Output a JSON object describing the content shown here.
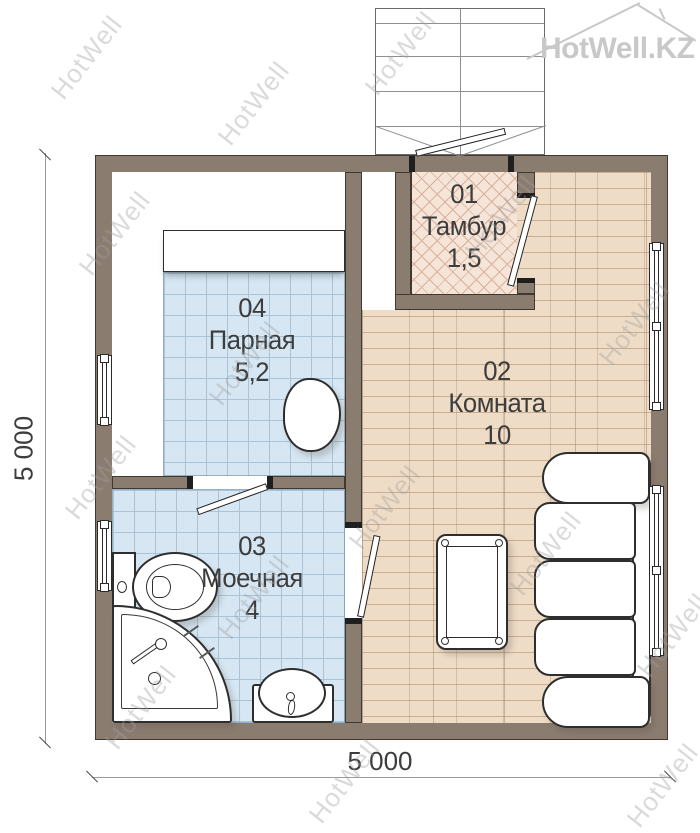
{
  "logo": {
    "brand": "HotWell.KZ"
  },
  "watermark": {
    "text": "HotWell",
    "positions": [
      [
        38,
        42
      ],
      [
        205,
        88
      ],
      [
        352,
        38
      ],
      [
        66,
        218
      ],
      [
        196,
        348
      ],
      [
        452,
        202
      ],
      [
        586,
        308
      ],
      [
        52,
        462
      ],
      [
        205,
        582
      ],
      [
        336,
        492
      ],
      [
        497,
        538
      ],
      [
        624,
        620
      ],
      [
        92,
        692
      ],
      [
        296,
        766
      ],
      [
        614,
        770
      ]
    ]
  },
  "rooms": {
    "vestibule": {
      "num": "01",
      "name": "Тамбур",
      "area": "1,5"
    },
    "living": {
      "num": "02",
      "name": "Комната",
      "area": "10"
    },
    "washing": {
      "num": "03",
      "name": "Моечная",
      "area": "4"
    },
    "steam": {
      "num": "04",
      "name": "Парная",
      "area": "5,2"
    }
  },
  "dimensions": {
    "width": "5 000",
    "height": "5 000"
  },
  "colors": {
    "wall": "#8b7c70",
    "wall-line": "#3f3931",
    "tile": "#d6e7f3",
    "tile-line": "#a9c4d6",
    "wood": "#eedcc6",
    "wood-line": "#c9ae93",
    "brick": "#f5e4d8",
    "brick-line": "#dab09a",
    "label": "#3d3d3d",
    "watermark-gray": "#a0a0a0",
    "logo-gray": "#c8c8c8"
  }
}
